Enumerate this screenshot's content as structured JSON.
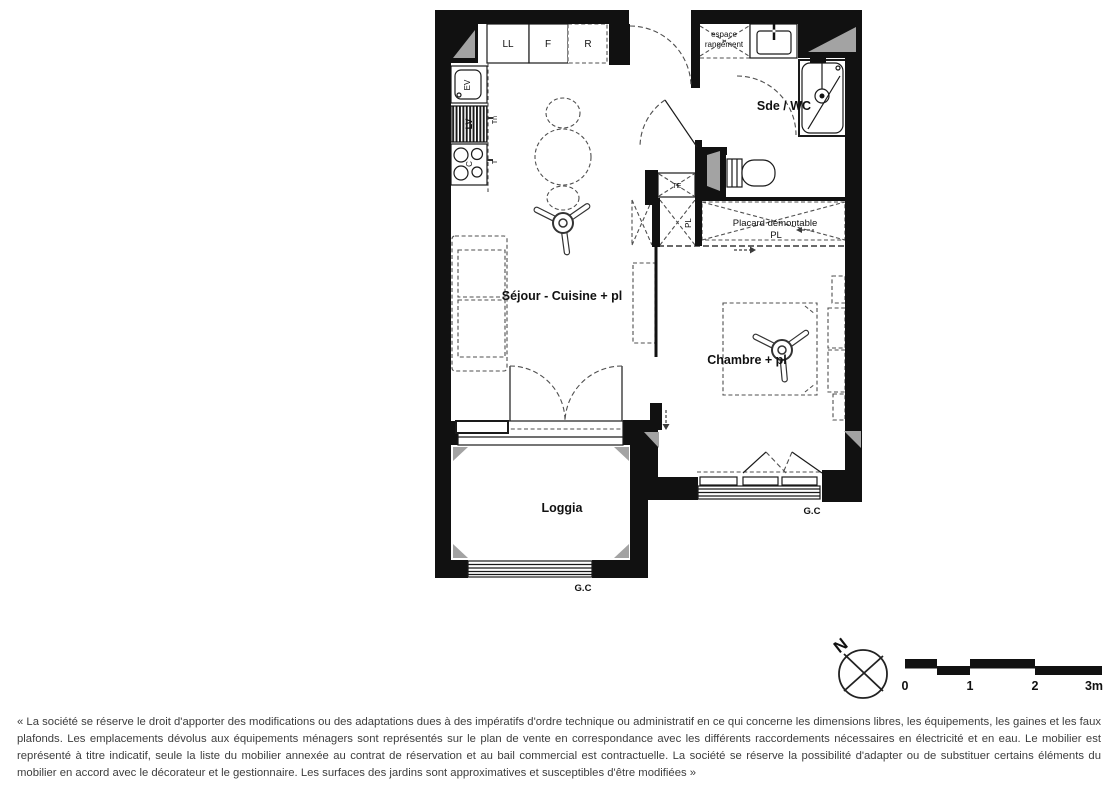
{
  "plan": {
    "room_labels": {
      "sejour": "Séjour - Cuisine + pl",
      "chambre": "Chambre + pl",
      "loggia": "Loggia",
      "sde_wc": "Sde / WC",
      "espace_line1": "espace",
      "espace_line2": "rangement",
      "placard_demontable": "Placard démontable",
      "placard_demontable_sub": "PL"
    },
    "fixture_labels": {
      "washing_machine": "LL",
      "fridge": "F",
      "reserved_slot": "R",
      "sink": "EV",
      "dishwasher": "LV",
      "cooktop": "C",
      "tech_mark_upper": "Tn",
      "tech_mark_lower": "T",
      "technical_box": "TE",
      "closet_vertical": "PL"
    },
    "annotations": {
      "gc_loggia": "G.C",
      "gc_chambre": "G.C"
    },
    "compass": {
      "north_label": "N"
    },
    "scale_bar": {
      "tick0": "0",
      "tick1": "1",
      "tick2": "2",
      "tick3": "3m"
    }
  },
  "footer": {
    "disclaimer": "« La société se réserve le droit d'apporter des modifications ou des adaptations dues à des impératifs d'ordre technique ou administratif en ce qui concerne les dimensions libres, les équipements, les gaines et les faux plafonds. Les emplacements dévolus aux équipements ménagers sont représentés sur le plan de vente en correspondance avec les différents raccordements nécessaires en électricité et en eau. Le mobilier est représenté à titre indicatif, seule la liste du mobilier annexée au contrat de réservation et au bail commercial est contractuelle. La société se réserve la possibilité d'adapter ou de substituer certains éléments du mobilier en accord avec le décorateur et le gestionnaire. Les surfaces des jardins sont approximatives et susceptibles d'être modifiées »"
  },
  "colors": {
    "wall": "#111111",
    "furniture_line": "#4f4f4f",
    "duct_fill": "#a3a3a3",
    "disclaimer_text": "#3d3d3d",
    "background": "#ffffff"
  }
}
